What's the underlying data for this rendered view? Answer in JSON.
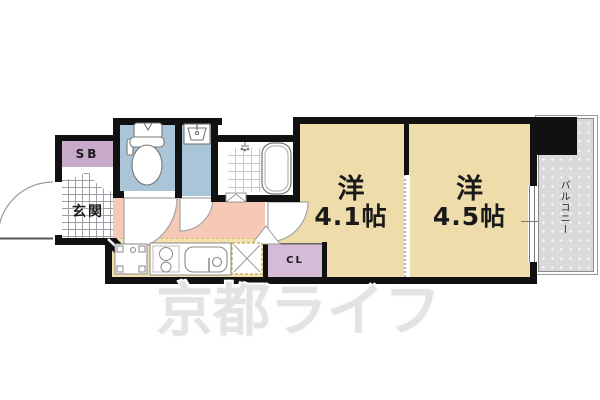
{
  "plan": {
    "entrance": {
      "label": "玄関"
    },
    "shoe_box": {
      "label": "SB"
    },
    "room1": {
      "type_label": "洋",
      "size_label": "4.1帖"
    },
    "room2": {
      "type_label": "洋",
      "size_label": "4.5帖"
    },
    "closet": {
      "label": "CL"
    },
    "balcony": {
      "label": "バルコニー"
    },
    "watermark": {
      "text": "京都ライフ"
    },
    "fixture_icons": [
      "toilet-icon",
      "washbasin-icon",
      "bathtub-icon",
      "shower-icon",
      "refrigerator-icon",
      "stove-icon",
      "kitchen-sink-icon",
      "washing-machine-pan-icon",
      "door-swing-icon",
      "front-door-swing-icon",
      "folding-door-icon",
      "sliding-window-icon"
    ],
    "colors": {
      "wall": "#111111",
      "western_room": "#eedcab",
      "wet_area": "#aac4d8",
      "hallway": "#f5c9b5",
      "kitchen": "#f2e2b0",
      "shoe_box": "#c7a9c9",
      "closet": "#d5bcd6",
      "balcony": "#dadada",
      "watermark": "#e3e3e3"
    }
  }
}
